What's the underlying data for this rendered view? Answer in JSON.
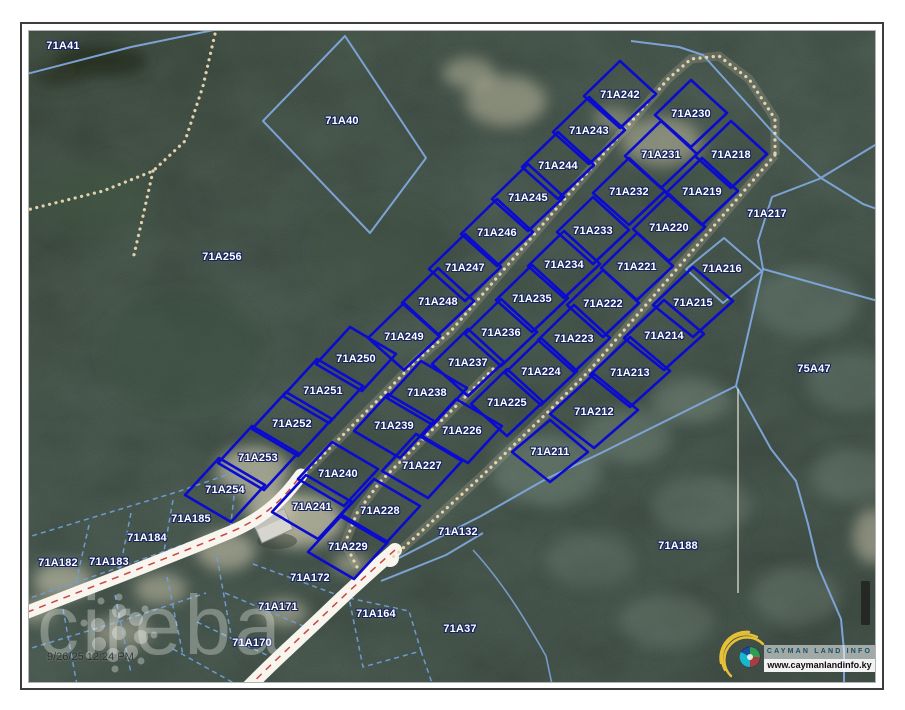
{
  "map": {
    "watermark_text": "cireba",
    "timestamp": "9/26/25 12:24 PM",
    "logo": {
      "title": "CAYMAN LAND INFO",
      "url": "www.caymanlandinfo.ky"
    },
    "colors": {
      "highlight_parcel": "#0b0bd0",
      "cadastral_line": "#7fa8dc",
      "road_centerline": "#c8322e",
      "label_text": "#ffffff",
      "label_outline": "#17235f"
    },
    "labels": [
      {
        "t": "71A41",
        "x": 62,
        "y": 45
      },
      {
        "t": "71A40",
        "x": 341,
        "y": 120
      },
      {
        "t": "71A256",
        "x": 221,
        "y": 256
      },
      {
        "t": "71A242",
        "x": 619,
        "y": 94,
        "s": "u"
      },
      {
        "t": "71A230",
        "x": 690,
        "y": 113,
        "s": "u"
      },
      {
        "t": "71A243",
        "x": 588,
        "y": 130,
        "s": "u"
      },
      {
        "t": "71A231",
        "x": 660,
        "y": 154,
        "s": "u"
      },
      {
        "t": "71A218",
        "x": 730,
        "y": 154,
        "s": "u"
      },
      {
        "t": "71A244",
        "x": 557,
        "y": 165,
        "s": "u"
      },
      {
        "t": "71A232",
        "x": 628,
        "y": 191,
        "s": "u"
      },
      {
        "t": "71A219",
        "x": 701,
        "y": 191,
        "s": "u"
      },
      {
        "t": "71A217",
        "x": 766,
        "y": 213
      },
      {
        "t": "71A245",
        "x": 527,
        "y": 197,
        "s": "u"
      },
      {
        "t": "71A233",
        "x": 592,
        "y": 230,
        "s": "u"
      },
      {
        "t": "71A220",
        "x": 668,
        "y": 227,
        "s": "u"
      },
      {
        "t": "71A246",
        "x": 496,
        "y": 232,
        "s": "u"
      },
      {
        "t": "71A234",
        "x": 563,
        "y": 264,
        "s": "u"
      },
      {
        "t": "71A221",
        "x": 636,
        "y": 266,
        "s": "u"
      },
      {
        "t": "71A216",
        "x": 721,
        "y": 268
      },
      {
        "t": "71A247",
        "x": 464,
        "y": 267,
        "s": "u"
      },
      {
        "t": "71A235",
        "x": 531,
        "y": 298,
        "s": "u"
      },
      {
        "t": "71A222",
        "x": 602,
        "y": 303,
        "s": "u"
      },
      {
        "t": "71A215",
        "x": 692,
        "y": 302,
        "s": "b1"
      },
      {
        "t": "71A248",
        "x": 437,
        "y": 301,
        "s": "u"
      },
      {
        "t": "71A249",
        "x": 403,
        "y": 336,
        "s": "u"
      },
      {
        "t": "71A236",
        "x": 500,
        "y": 332,
        "s": "u"
      },
      {
        "t": "71A223",
        "x": 573,
        "y": 338,
        "s": "u"
      },
      {
        "t": "71A214",
        "x": 663,
        "y": 335,
        "s": "b1"
      },
      {
        "t": "71A250",
        "x": 355,
        "y": 358,
        "s": "l"
      },
      {
        "t": "71A237",
        "x": 467,
        "y": 362,
        "s": "u"
      },
      {
        "t": "71A224",
        "x": 540,
        "y": 371,
        "s": "u"
      },
      {
        "t": "71A213",
        "x": 629,
        "y": 372,
        "s": "b1"
      },
      {
        "t": "71A251",
        "x": 322,
        "y": 390,
        "s": "l"
      },
      {
        "t": "71A238",
        "x": 426,
        "y": 392,
        "s": "l"
      },
      {
        "t": "71A225",
        "x": 506,
        "y": 402,
        "s": "u"
      },
      {
        "t": "71A212",
        "x": 593,
        "y": 411,
        "s": "b2"
      },
      {
        "t": "71A252",
        "x": 291,
        "y": 423,
        "s": "l"
      },
      {
        "t": "71A239",
        "x": 393,
        "y": 425,
        "s": "l"
      },
      {
        "t": "71A226",
        "x": 461,
        "y": 430,
        "s": "l"
      },
      {
        "t": "71A253",
        "x": 257,
        "y": 457,
        "s": "l"
      },
      {
        "t": "71A240",
        "x": 337,
        "y": 473,
        "s": "l"
      },
      {
        "t": "71A227",
        "x": 421,
        "y": 465,
        "s": "l"
      },
      {
        "t": "71A211",
        "x": 549,
        "y": 451,
        "s": "b3"
      },
      {
        "t": "71A254",
        "x": 224,
        "y": 489,
        "s": "l"
      },
      {
        "t": "71A241",
        "x": 311,
        "y": 506,
        "s": "l"
      },
      {
        "t": "71A228",
        "x": 379,
        "y": 510,
        "s": "l"
      },
      {
        "t": "71A185",
        "x": 190,
        "y": 518
      },
      {
        "t": "71A229",
        "x": 347,
        "y": 546,
        "s": "l"
      },
      {
        "t": "71A184",
        "x": 146,
        "y": 537
      },
      {
        "t": "71A182",
        "x": 57,
        "y": 562
      },
      {
        "t": "71A183",
        "x": 108,
        "y": 561
      },
      {
        "t": "71A172",
        "x": 309,
        "y": 577
      },
      {
        "t": "71A171",
        "x": 277,
        "y": 606
      },
      {
        "t": "71A164",
        "x": 375,
        "y": 613
      },
      {
        "t": "71A170",
        "x": 251,
        "y": 642
      },
      {
        "t": "71A37",
        "x": 459,
        "y": 628
      },
      {
        "t": "71A132",
        "x": 457,
        "y": 531
      },
      {
        "t": "71A188",
        "x": 677,
        "y": 545
      },
      {
        "t": "75A47",
        "x": 813,
        "y": 368
      }
    ]
  }
}
